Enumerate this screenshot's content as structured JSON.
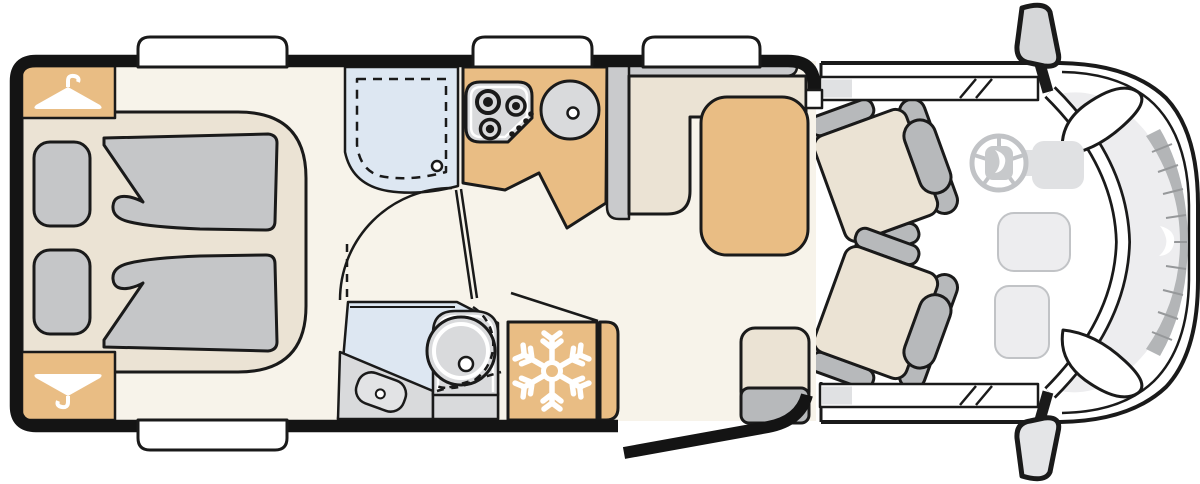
{
  "title": "Motorhome floor plan (top view)",
  "colors": {
    "outline": "#1a1a1a",
    "wood": "#e9bd84",
    "floor": "#f7f3ea",
    "upholstery": "#ebe3d4",
    "bedding": "#c5c6c8",
    "seatgray": "#b7b9bb",
    "bench": "#c9cacc",
    "wetroom": "#dde7f2",
    "fixture": "#d9dadc",
    "cablight": "#ededef",
    "cabmid": "#e0e1e3",
    "grille": "#b3b5b7"
  },
  "areas": {
    "bedroom": "Rear bedroom with two single beds and pillows",
    "wardrobe_top": "Wardrobe with clothes hanger",
    "wardrobe_bottom": "Wardrobe with clothes hanger",
    "shower": "Shower cubicle with drain",
    "washroom": "Washroom with swivel toilet and vanity basin",
    "kitchen": "Kitchen block with 3-burner hob and round sink",
    "fridge": "Refrigerator",
    "dinette": "L-shaped dinette bench with table",
    "side_seat": "Single side seat at entrance",
    "entry_door": "Entrance door shown open",
    "cab": "Driver cab with two swivel seats, steering wheel and wing mirrors"
  },
  "icons": {
    "hanger": "clothes-hanger",
    "snowflake": "snowflake",
    "burners": "hob-burners",
    "sink": "round-sink",
    "steering_wheel": "steering-wheel",
    "wing_mirror": "wing-mirror",
    "logo": "logo-swoosh"
  },
  "counts": {
    "windows": "4",
    "beds": "2",
    "pillows": "2",
    "hob_burners": "3",
    "cab_seats": "2",
    "dinette_table": "1"
  }
}
